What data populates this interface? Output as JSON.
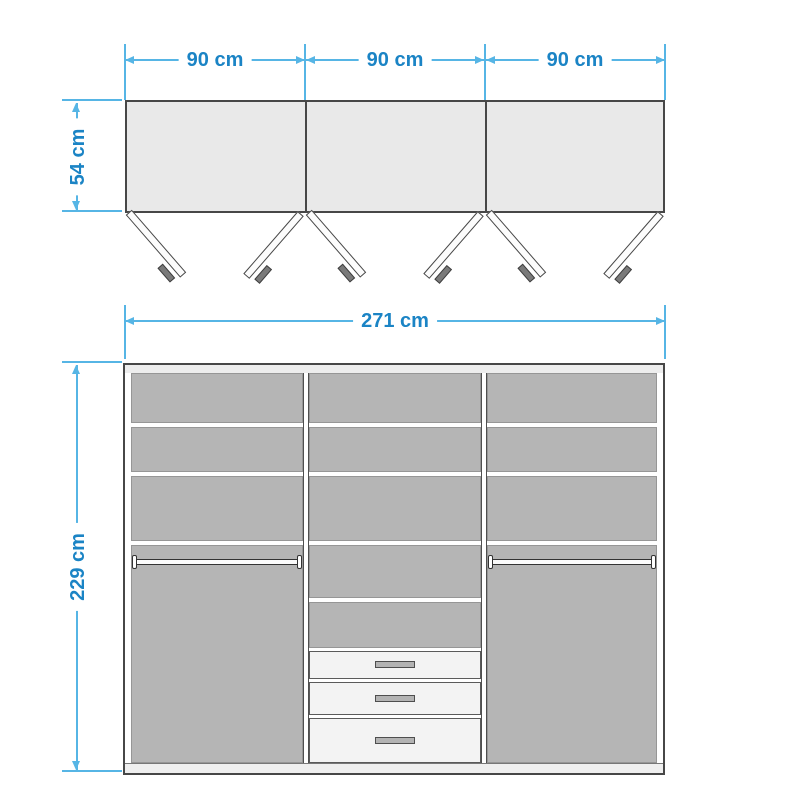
{
  "colors": {
    "dimension_line": "#56b5e5",
    "dimension_text": "#1b84c5",
    "cabinet_outline": "#474747",
    "interior_gray": "#b5b5b5"
  },
  "top_view": {
    "panel_width_labels": [
      "90 cm",
      "90 cm",
      "90 cm"
    ],
    "depth_label": "54 cm",
    "door_count": 6
  },
  "front_view": {
    "total_width_label": "271 cm",
    "total_height_label": "229 cm",
    "drawer_count": 3,
    "hanging_rail_count": 2
  }
}
